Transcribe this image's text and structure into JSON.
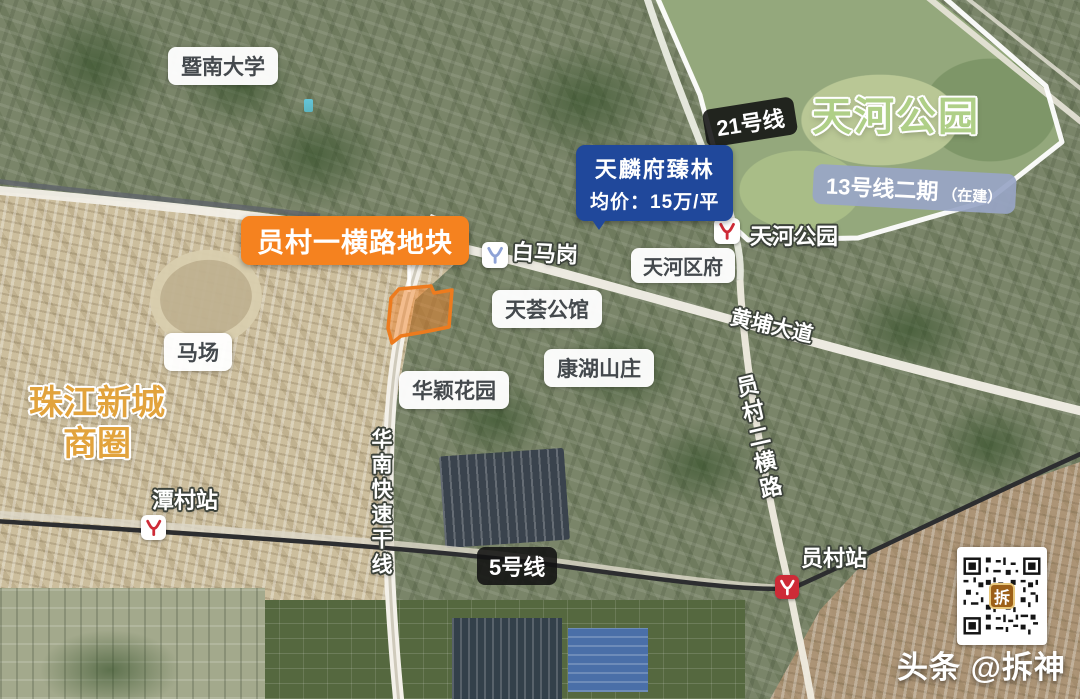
{
  "labels": {
    "university": "暨南大学",
    "park": "天河公园",
    "line21": "21号线",
    "line13": "13号线二期",
    "line13_status": "（在建）",
    "project": "天麟府臻林",
    "price": "均价：15万/平",
    "plot": "员村一横路地块",
    "baimagang": "白马岗",
    "tianhe_station": "天河公园",
    "district_gov": "天河区府",
    "tianhui": "天荟公馆",
    "kanghu": "康湖山庄",
    "racecourse": "马场",
    "huaying": "华颖花园",
    "zhujiang1": "珠江新城",
    "zhujiang2": "商圈",
    "tancun": "潭村站",
    "line5": "5号线",
    "expressway": "华南快速干线",
    "yuancun_road": "员村二横路",
    "yuancun_station": "员村站",
    "huangpu": "黄埔大道"
  },
  "qr": {
    "logo_char": "拆"
  },
  "watermark": {
    "text": "头条 @拆神"
  },
  "colors": {
    "plot_accent": "#ED7B1E",
    "price_box": "#20489B",
    "line13_box": "#98A5C5",
    "metro_red": "#CE2B37",
    "metro_blue": "#8EA2D6",
    "park_text": "#AFCF87",
    "business_text": "#E2A33C",
    "metro_line": "#2D2E30"
  }
}
